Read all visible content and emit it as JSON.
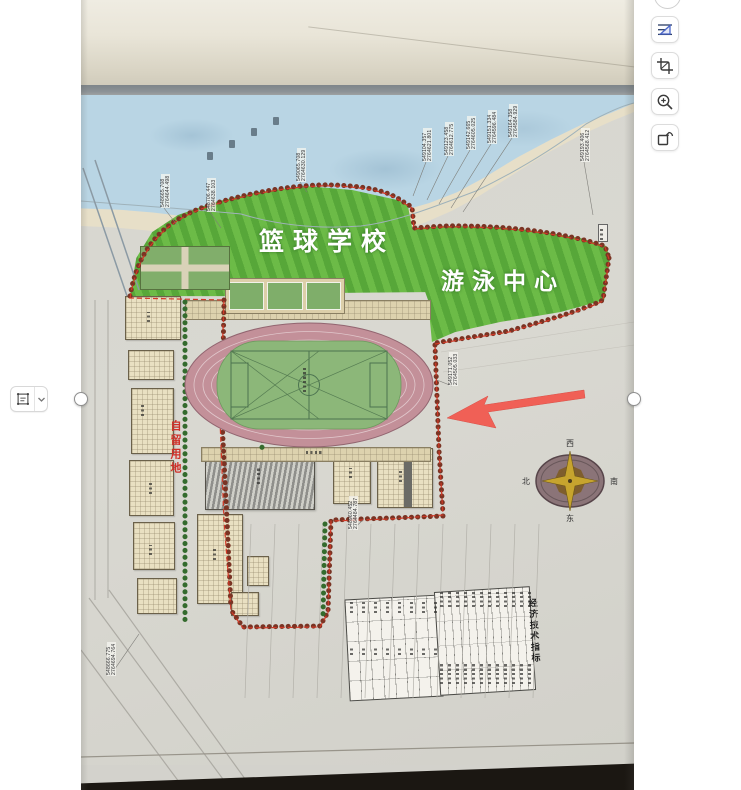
{
  "ui": {
    "right_toolbar": {
      "buttons": [
        {
          "name": "straighten"
        },
        {
          "name": "crop"
        },
        {
          "name": "zoom-in"
        },
        {
          "name": "rotate"
        }
      ]
    },
    "left_tool": {
      "name": "select-region",
      "has_dropdown": true
    }
  },
  "plan": {
    "labels": {
      "basketball_school": "篮球学校",
      "swimming_center": "游泳中心",
      "reserved_land": "自留用地",
      "table_title": "经济技术指标"
    },
    "compass": {
      "top": "西",
      "left": "北",
      "right": "南",
      "bottom": "东"
    },
    "coord_labels": [
      {
        "x": 80,
        "y": 208,
        "tx": 96,
        "ty": 225,
        "a": "548665.708",
        "b": "2764644.498"
      },
      {
        "x": 126,
        "y": 212,
        "tx": 140,
        "ty": 228,
        "a": "548706.447",
        "b": "2764638.103"
      },
      {
        "x": 216,
        "y": 182,
        "tx": 226,
        "ty": 192,
        "a": "549065.708",
        "b": "2764630.129"
      },
      {
        "x": 342,
        "y": 162,
        "tx": 332,
        "ty": 196,
        "a": "549104.357",
        "b": "2764621.801"
      },
      {
        "x": 364,
        "y": 156,
        "tx": 346,
        "ty": 200,
        "a": "549123.458",
        "b": "2764612.775"
      },
      {
        "x": 386,
        "y": 150,
        "tx": 358,
        "ty": 204,
        "a": "549142.665",
        "b": "2764605.025"
      },
      {
        "x": 407,
        "y": 144,
        "tx": 370,
        "ty": 208,
        "a": "549151.334",
        "b": "2764596.484"
      },
      {
        "x": 428,
        "y": 138,
        "tx": 382,
        "ty": 212,
        "a": "549164.358",
        "b": "2764584.929"
      },
      {
        "x": 500,
        "y": 162,
        "tx": 512,
        "ty": 215,
        "a": "549193.406",
        "b": "2764568.412"
      },
      {
        "x": 368,
        "y": 386,
        "tx": 356,
        "ty": 380,
        "a": "549171.052",
        "b": "2764505.033"
      },
      {
        "x": 268,
        "y": 530,
        "tx": 282,
        "ty": 520,
        "a": "548960.452",
        "b": "2764484.787"
      },
      {
        "x": 26,
        "y": 676,
        "tx": 58,
        "ty": 634,
        "a": "548666.775",
        "b": "2764694.764"
      }
    ],
    "colors": {
      "lawn_dark": "#57a739",
      "lawn_light": "#6cbb47",
      "track": "#c39099",
      "infield": "#8cb779",
      "water": "#b9d5e4",
      "annotation_arrow": "#f3564c",
      "boundary_red": "#d23826"
    }
  }
}
